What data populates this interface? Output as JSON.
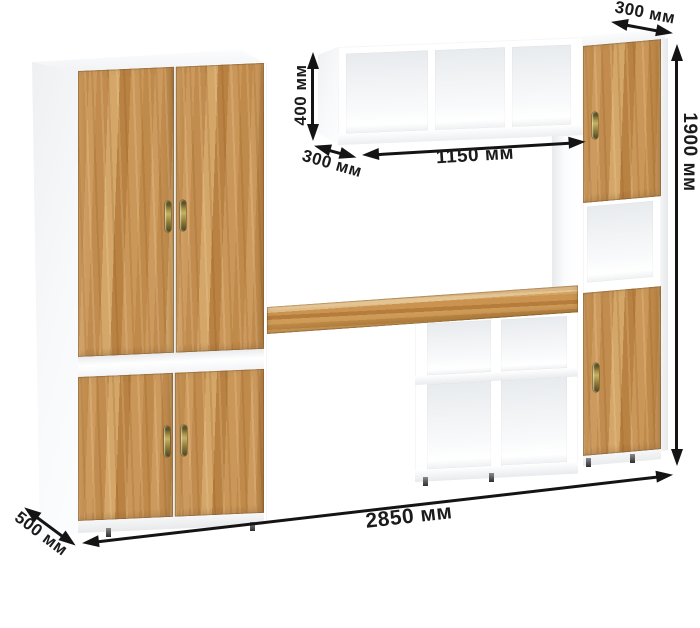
{
  "diagram": {
    "type": "furniture-dimension-diagram",
    "object": "wall unit with wardrobe, desk and shelving",
    "unit": "мм",
    "dimensions": {
      "wardrobe_top_depth": "300 мм",
      "overall_height": "1900 мм",
      "wall_shelf_height": "400 мм",
      "wall_shelf_depth": "300 мм",
      "wall_shelf_width": "1150 мм",
      "wardrobe_depth": "500 мм",
      "overall_width": "2850 мм"
    },
    "dimensions_numeric_mm": {
      "wardrobe_top_depth": 300,
      "overall_height": 1900,
      "wall_shelf_height": 400,
      "wall_shelf_depth": 300,
      "wall_shelf_width": 1150,
      "wardrobe_depth": 500,
      "overall_width": 2850
    },
    "colors": {
      "wood": "#c8924f",
      "carcass": "#ffffff",
      "annotation": "#1a1a1a",
      "handle_brass": "#8f7f3c"
    }
  }
}
